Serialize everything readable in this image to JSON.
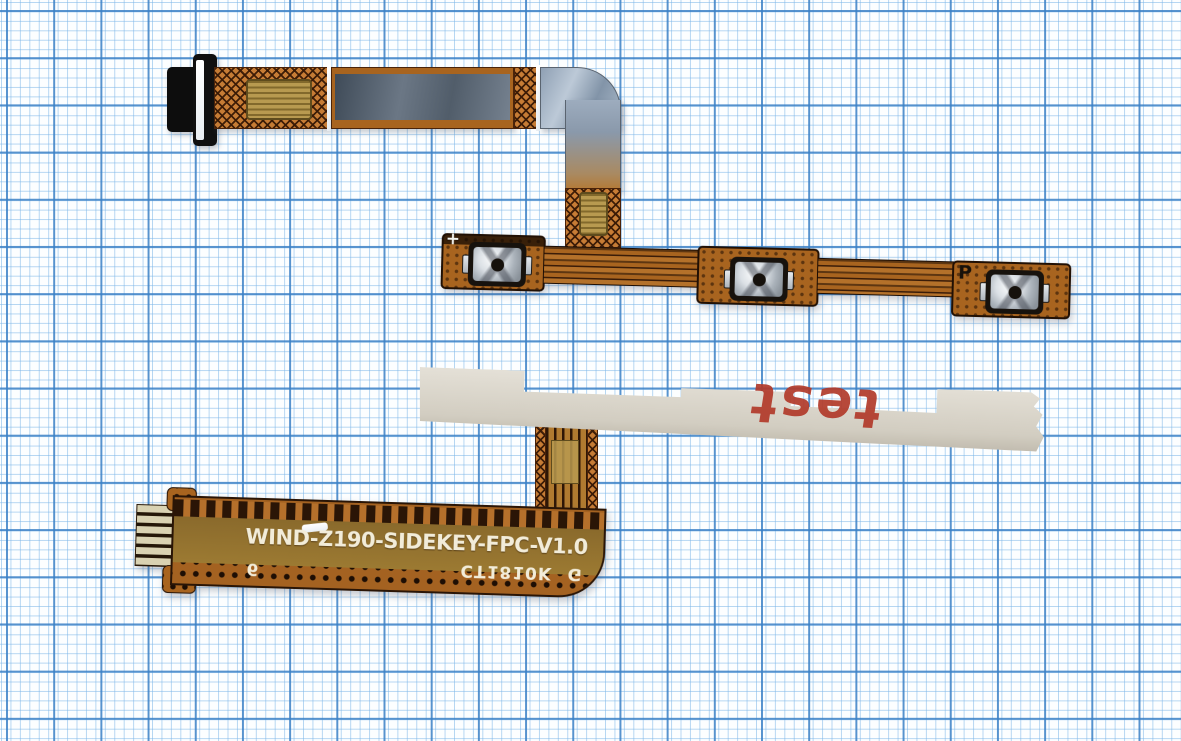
{
  "scene": {
    "description": "Product photo: two side-key FPC flex cables (power / volume buttons) for WIND Z190 phone laid on blue-grid graph paper",
    "paper": {
      "background": "#fcfeff",
      "grid_minor_color": "#7db6e8",
      "grid_major_color": "#3a80c6"
    }
  },
  "top_flex": {
    "connector": "black-board-connector",
    "labels": {
      "volume_plus": "+",
      "power": "P"
    },
    "buttons": [
      "volume-up-dome-switch",
      "volume-down-dome-switch",
      "power-dome-switch"
    ]
  },
  "bottom_flex": {
    "silkscreen_model": "WIND-Z190-SIDEKEY-FPC-V1.0",
    "silkscreen_batch": "CT1810K",
    "silkscreen_batch_suffix": "G",
    "silkscreen_digit": "6",
    "handwritten_mark": "test",
    "handwritten_color": "#b23a2a"
  },
  "colors": {
    "copper": "#a8641f",
    "copper_dark": "#2a1506",
    "mesh_copper": "#c67c35",
    "emi_shield_dark": "#4e5a66",
    "emi_shield_light": "#aab9c9",
    "gold_pad": "#b89a50",
    "stiffener_gray": "#d6d1c5",
    "connector_black": "#111111",
    "silkscreen_white": "#f2ecd9"
  }
}
